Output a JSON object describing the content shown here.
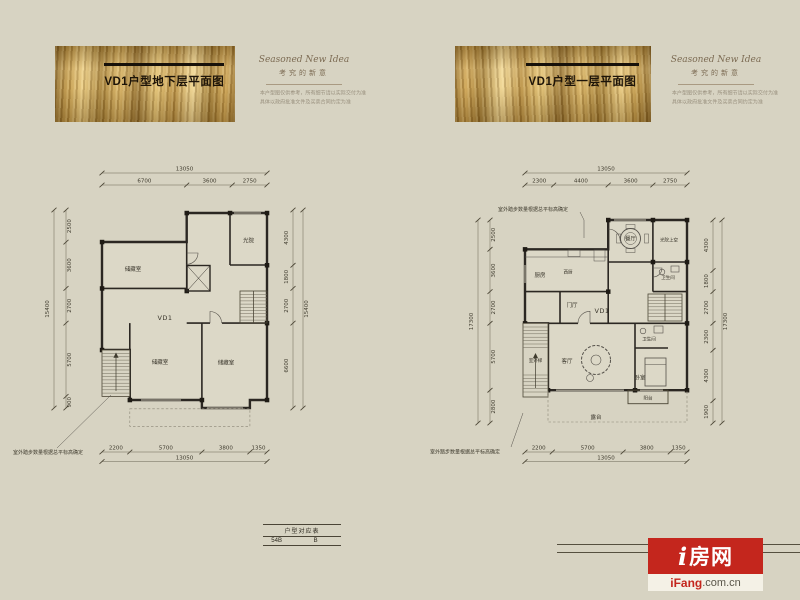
{
  "banners": [
    {
      "title": "VD1户型地下层平面图",
      "tagline_en": "Seasoned New Idea",
      "tagline_cn": "考究的新意",
      "disclaimer1": "本户型图仅供参考，所有细节请以实际交付为准",
      "disclaimer2": "具体以政府批准文件及买卖合同约定为准"
    },
    {
      "title": "VD1户型一层平面图",
      "tagline_en": "Seasoned New Idea",
      "tagline_cn": "考究的新意",
      "disclaimer1": "本户型图仅供参考，所有细节请以实际交付为准",
      "disclaimer2": "具体以政府批准文件及买卖合同约定为准"
    }
  ],
  "plans": [
    {
      "unit_label": "VD1",
      "annotation": "室外踏步数量根据总平标高确定",
      "rooms": {
        "storage_top": "储藏室",
        "light_court": "光院",
        "storage_bottom_left": "储藏室",
        "storage_bottom_right": "储藏室"
      },
      "dims": {
        "top_total": "13050",
        "top": [
          "6700",
          "3600",
          "2750"
        ],
        "bottom_total": "13050",
        "bottom": [
          "2200",
          "5700",
          "3800",
          "1350"
        ],
        "left_total": "15400",
        "left": [
          "2500",
          "3600",
          "2700",
          "5700",
          "900"
        ],
        "right_total": "15400",
        "right": [
          "4300",
          "1800",
          "2700",
          "6600"
        ]
      }
    },
    {
      "unit_label": "VD1",
      "annotation": "室外踏步数量根据总平标高确定",
      "rooms": {
        "dining": "餐厅",
        "light_court": "光院上空",
        "kitchen": "厨房",
        "west_kitchen": "西厨",
        "foyer": "门厅",
        "bath_mid": "卫生间",
        "bath_low": "卫生间",
        "living": "客厅",
        "bedroom": "卧室",
        "balcony": "阳台",
        "terrace": "露台",
        "outdoor_stair": "室外梯"
      },
      "dims": {
        "top_total": "13050",
        "top": [
          "2300",
          "4400",
          "3600",
          "2750"
        ],
        "bottom_total": "13050",
        "bottom": [
          "2200",
          "5700",
          "3800",
          "1350"
        ],
        "left_total": "17300",
        "left": [
          "2500",
          "3600",
          "2700",
          "5700",
          "2800"
        ],
        "right_total": "17300",
        "right": [
          "4300",
          "1800",
          "2700",
          "2300",
          "4300",
          "1900"
        ]
      }
    }
  ],
  "footer": {
    "table": {
      "header": "户型对应表",
      "cells": [
        "54B",
        "B"
      ]
    },
    "logo": {
      "name_i": "i",
      "name_rest": "房网",
      "site_brand": "iFang",
      "site_suffix": ".com.cn"
    }
  },
  "colors": {
    "accent_red": "#c4261d",
    "wall": "#2b2722",
    "background": "#d7d3c2",
    "banner_gold": "#c09a4c"
  }
}
